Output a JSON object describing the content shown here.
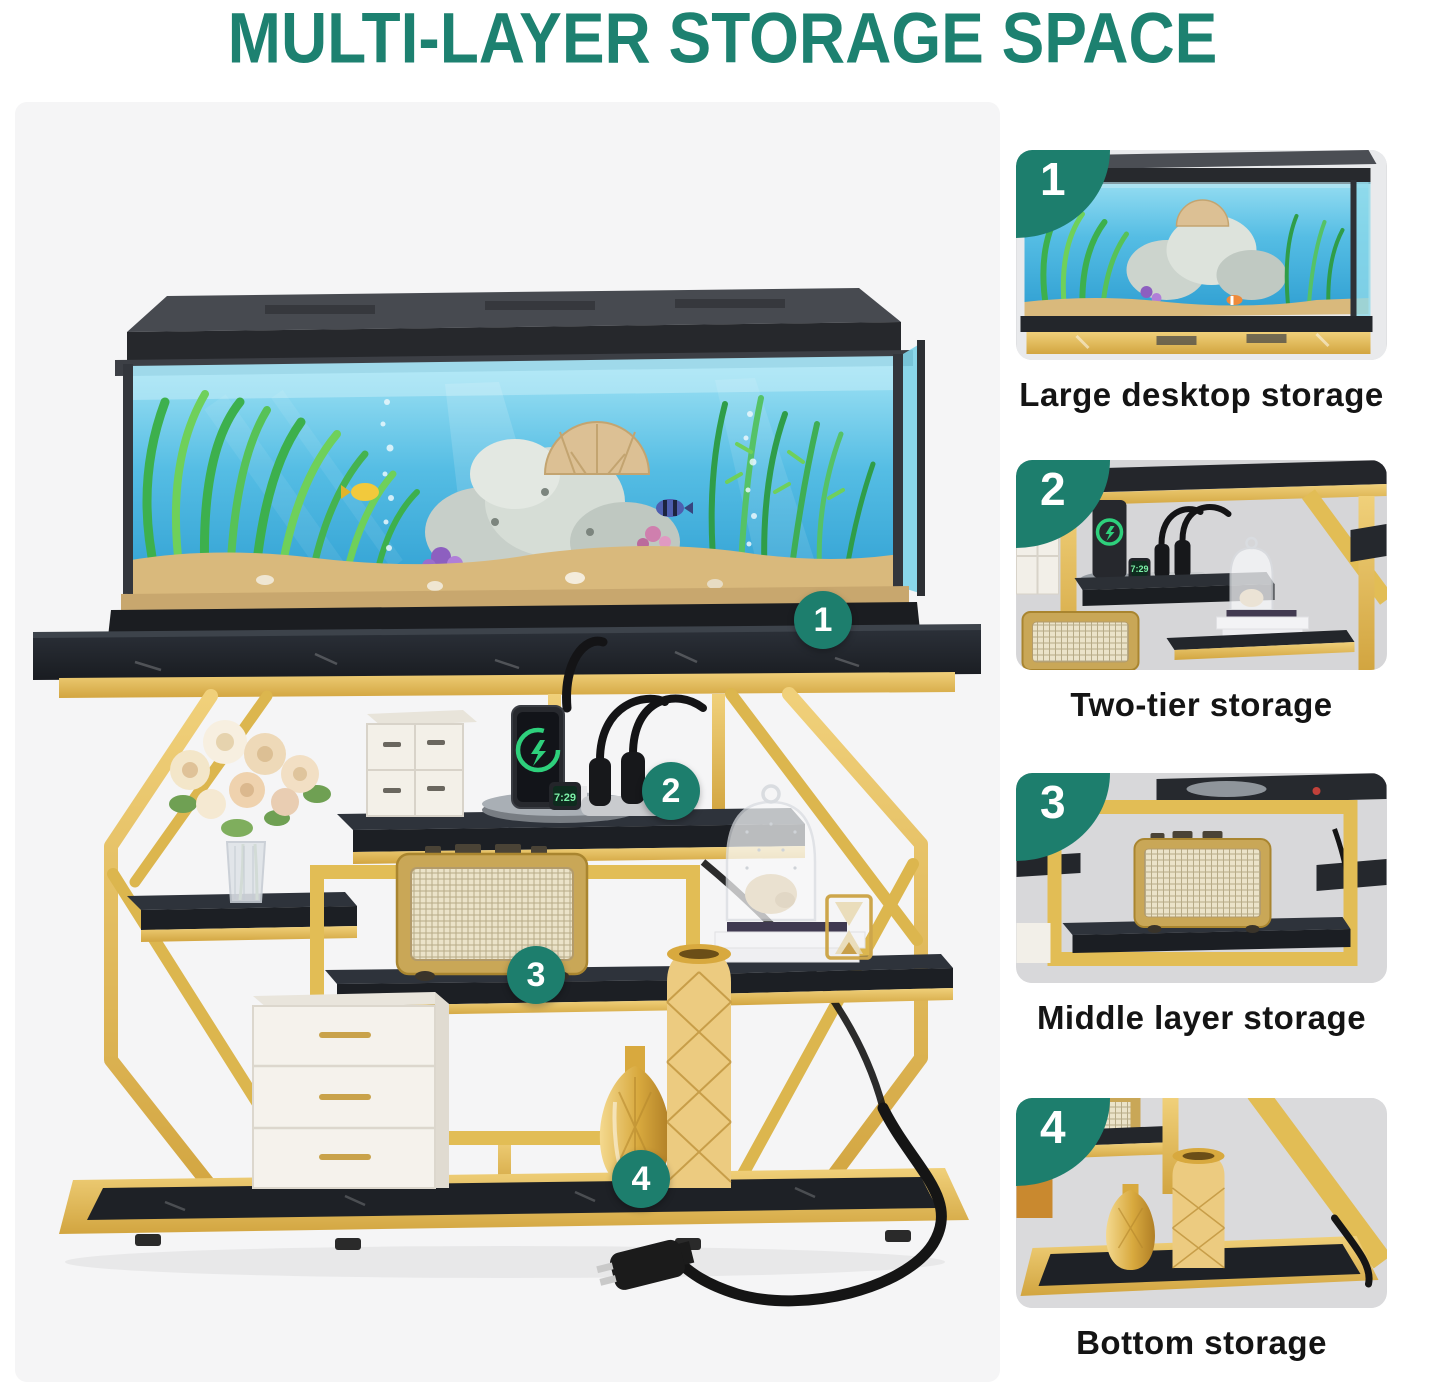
{
  "title": "MULTI-LAYER STORAGE SPACE",
  "main": {
    "callouts": [
      {
        "number": "1"
      },
      {
        "number": "2"
      },
      {
        "number": "3"
      },
      {
        "number": "4"
      }
    ],
    "scene": {
      "watch_time": "7:29"
    }
  },
  "thumbnails": [
    {
      "number": "1",
      "caption": "Large desktop storage"
    },
    {
      "number": "2",
      "caption": "Two-tier storage"
    },
    {
      "number": "3",
      "caption": "Middle layer storage"
    },
    {
      "number": "4",
      "caption": "Bottom storage"
    }
  ],
  "colors": {
    "accent_teal": "#1d7e6d",
    "title_teal": "#1d8170",
    "gold": "#e2bd55",
    "marble_black": "#23262c",
    "photo_background": "#f5f5f6",
    "thumb_background": "#d8d8da",
    "caption_text": "#141414"
  }
}
